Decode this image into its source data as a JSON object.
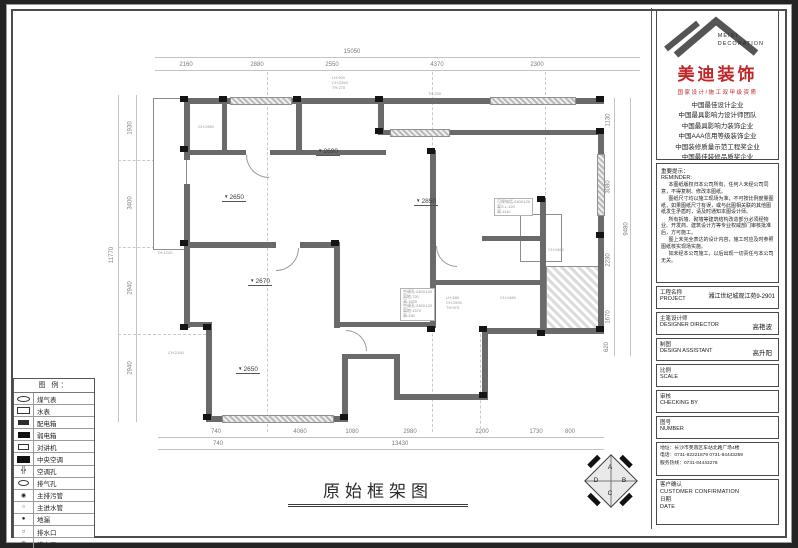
{
  "title_block": {
    "logo": {
      "brand_en_line1": "MEIDI",
      "brand_en_line2": "DECORATION",
      "brand_cn": "美迪装饰",
      "credential": "国家设计/施工双甲级资质",
      "accent_color": "#c02628",
      "honors": [
        "中国最佳设计企业",
        "中国最具影响力设计师团队",
        "中国最具影响力装饰企业",
        "中国AAA信用等级装饰企业",
        "中国装修质量示范工程奖企业",
        "中国最佳装修品质奖企业"
      ]
    },
    "reminder": {
      "label_cn": "重要提示：",
      "label_en": "REMINDER:",
      "paragraphs": [
        "本图纸版权归本公司所有，任何人未经公司同意，不得复制、修改本图纸。",
        "图纸尺寸均以施工现场为准，不可按比例度量图纸，如果图纸尺寸有误，或与此图相关联的其他图纸发生矛盾时，请及时通知本图设计师。",
        "所有拆墙、砌墙等建筑结构改造部分必须经物业、开发商、建筑设计方等专业权威部门审核批准后，方可施工。",
        "图上未完全表达的设计内容，施工时应及时参照图纸核实现场实施。",
        "如未经本公司施工，以后出现一切责任与本公司无关。"
      ]
    },
    "fields": {
      "project": {
        "label_cn": "工程名称",
        "label_en": "PROJECT",
        "value": "湘江世纪城观江苑9-2901"
      },
      "designer": {
        "label_cn": "主笔设计师",
        "label_en": "DESIGNER DIRECTOR",
        "value": "高艳波"
      },
      "assistant": {
        "label_cn": "制图",
        "label_en": "DESIGN ASSISTANT",
        "value": "高升阳"
      },
      "scale": {
        "label_cn": "比例",
        "label_en": "SCALE"
      },
      "checking": {
        "label_cn": "审核",
        "label_en": "CHECKING BY"
      },
      "number": {
        "label_cn": "图号",
        "label_en": "NUMBER"
      }
    },
    "contact": {
      "address": "地址：长沙市芙蓉区车站北路广场4楼",
      "phone": "电话：0731-82221879  0731-84443259",
      "hotline": "服务热线：0731-84443278"
    },
    "confirmation": {
      "label_cn": "客户确认",
      "label_en": "CUSTOMER CONFIRMATION",
      "date_cn": "日期",
      "date_en": "DATE"
    }
  },
  "drawing": {
    "title": "原始框架图",
    "dims": {
      "top_total": "15050",
      "top": [
        "2160",
        "2880",
        "2550",
        "4370",
        "2300"
      ],
      "bottom": [
        "740",
        "4060",
        "1080",
        "2980",
        "2200",
        "1730",
        "800"
      ],
      "bottom_total_row": [
        "740",
        "13430"
      ],
      "left": [
        "1930",
        "3400",
        "2940",
        "2940"
      ],
      "left_total": "11770",
      "right": [
        "1130",
        "3080",
        "2230",
        "1670",
        "620"
      ],
      "right_total": "9480"
    },
    "levels": [
      {
        "value": "2650"
      },
      {
        "value": "2690"
      },
      {
        "value": "2850"
      },
      {
        "value": "2670"
      },
      {
        "value": "2650"
      }
    ],
    "annotations": {
      "free": [
        "LH:900",
        "CH:2260",
        "TH:270",
        "TH:200",
        "CH:1980",
        "CH:1560",
        "TH:1220",
        "CH:2160",
        "CH:1580",
        "LH:380",
        "CH:1530",
        "TH:970"
      ],
      "intercom_box": [
        "可视电话:240X120",
        "离S.L:120",
        "高:1110"
      ],
      "ac_box": [
        "空调孔:240X120",
        "离地:720",
        "高:1520",
        "空调孔:240X120",
        "离地:1370",
        "高:330"
      ]
    },
    "compass": {
      "a": "A",
      "b": "B",
      "c": "C",
      "d": "D"
    }
  },
  "legend": {
    "header": "图 例：",
    "items": [
      {
        "label": "煤气表"
      },
      {
        "label": "水表"
      },
      {
        "label": "配电箱"
      },
      {
        "label": "弱电箱"
      },
      {
        "label": "对讲机"
      },
      {
        "label": "中央空调"
      },
      {
        "label": "空调孔"
      },
      {
        "label": "排气孔"
      },
      {
        "label": "主排污管"
      },
      {
        "label": "主进水管"
      },
      {
        "label": "地漏"
      },
      {
        "label": "排水口"
      },
      {
        "label": "排水口"
      }
    ]
  }
}
